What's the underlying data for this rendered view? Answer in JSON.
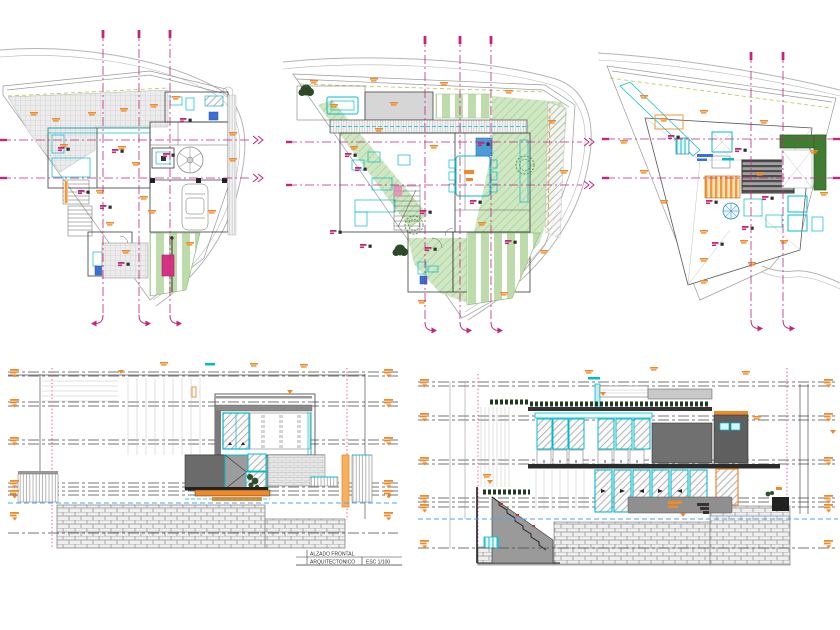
{
  "canvas": {
    "width": 840,
    "height": 630,
    "background": "#ffffff"
  },
  "title_block": {
    "title": "ALZADO FRONTAL",
    "discipline": "ARQUITECTONICO",
    "scale": "ESC 1/100"
  },
  "colors": {
    "grid_axis": "#c2267d",
    "detail_cyan": "#00bccd",
    "annotation_orange": "#f08a28",
    "lawn_green": "#cfe7c2",
    "hedge_green": "#3f7d33",
    "masonry_gray": "#9a9a9a",
    "dark_mass": "#6b6b6b",
    "level_line": "#4a4a4a",
    "water_blue": "#4da3ff",
    "boundary_gray": "#b4b4b4",
    "highlight_pink": "#ff5fae",
    "fill_pink": "#d63384",
    "kitchen_blue": "#4a9bd8"
  }
}
